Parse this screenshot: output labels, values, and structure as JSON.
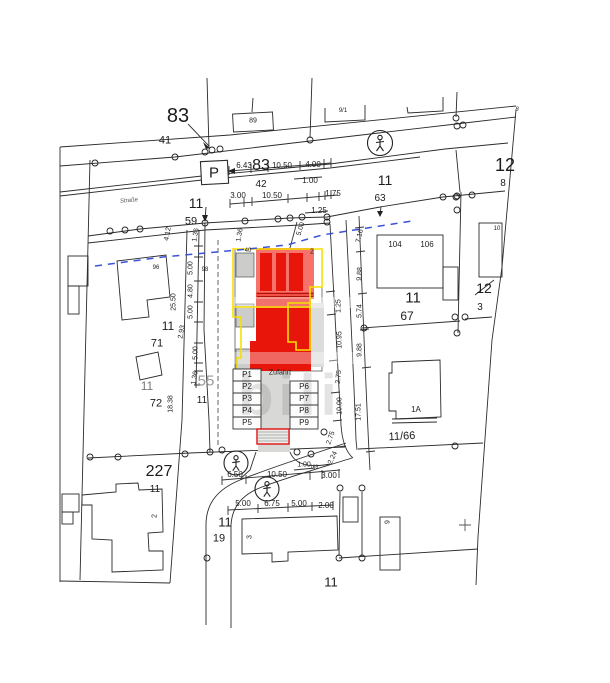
{
  "map": {
    "watermark": "bili",
    "colors": {
      "highlight_red": "#e8150b",
      "highlight_red_light": "#f5736a",
      "outline_yellow": "#f5e000",
      "guide_blue": "#3a52d8",
      "existing_gray": "#d8d8d6",
      "line_ink": "#2b2b2b"
    },
    "parking": {
      "driveway_label": "Zufahrt",
      "spaces": [
        "P1",
        "P2",
        "P3",
        "P4",
        "P5",
        "P6",
        "P7",
        "P8",
        "P9"
      ]
    },
    "labels": [
      {
        "t": "83",
        "x": 178,
        "y": 116,
        "s": 20
      },
      {
        "t": "41",
        "x": 165,
        "y": 141,
        "s": 11
      },
      {
        "t": "89",
        "x": 253,
        "y": 121,
        "s": 7
      },
      {
        "t": "9/1",
        "x": 343,
        "y": 111,
        "s": 6
      },
      {
        "t": "P",
        "x": 214,
        "y": 173,
        "s": 15
      },
      {
        "t": "6.43",
        "x": 244,
        "y": 166,
        "s": 8
      },
      {
        "t": "83",
        "x": 261,
        "y": 166,
        "s": 16
      },
      {
        "t": "10.50",
        "x": 282,
        "y": 166,
        "s": 8
      },
      {
        "t": "4.00",
        "x": 313,
        "y": 165,
        "s": 8
      },
      {
        "t": "1.00",
        "x": 310,
        "y": 181,
        "s": 8
      },
      {
        "t": "42",
        "x": 261,
        "y": 185,
        "s": 10
      },
      {
        "t": "3.00",
        "x": 238,
        "y": 196,
        "s": 8
      },
      {
        "t": "10.50",
        "x": 272,
        "y": 196,
        "s": 8
      },
      {
        "t": "1.75",
        "x": 333,
        "y": 194,
        "s": 8
      },
      {
        "t": "1.25",
        "x": 319,
        "y": 211,
        "s": 8
      },
      {
        "t": "11",
        "x": 196,
        "y": 203,
        "s": 14
      },
      {
        "t": "59",
        "x": 191,
        "y": 222,
        "s": 11
      },
      {
        "t": "11",
        "x": 385,
        "y": 180,
        "s": 14
      },
      {
        "t": "63",
        "x": 380,
        "y": 199,
        "s": 10
      },
      {
        "t": "12",
        "x": 505,
        "y": 165,
        "s": 18
      },
      {
        "t": "8",
        "x": 503,
        "y": 184,
        "s": 10
      },
      {
        "t": "8",
        "x": 517,
        "y": 110,
        "s": 6,
        "i": 1
      },
      {
        "t": "Straße",
        "x": 129,
        "y": 201,
        "s": 6,
        "r": -5,
        "c": "#555555",
        "i": 1
      },
      {
        "t": "96",
        "x": 156,
        "y": 268,
        "s": 6
      },
      {
        "t": "98",
        "x": 205,
        "y": 270,
        "s": 6
      },
      {
        "t": "25.50",
        "x": 174,
        "y": 302,
        "s": 7,
        "r": -90
      },
      {
        "t": "4.12",
        "x": 168,
        "y": 234,
        "s": 7,
        "r": -80
      },
      {
        "t": "1.36",
        "x": 196,
        "y": 235,
        "s": 7,
        "r": -80
      },
      {
        "t": "1.36",
        "x": 240,
        "y": 235,
        "s": 7,
        "r": -80
      },
      {
        "t": "5.00",
        "x": 191,
        "y": 268,
        "s": 7,
        "r": -90
      },
      {
        "t": "4.80",
        "x": 191,
        "y": 291,
        "s": 7,
        "r": -90
      },
      {
        "t": "5.00",
        "x": 191,
        "y": 312,
        "s": 7,
        "r": -90
      },
      {
        "t": "2.93",
        "x": 182,
        "y": 332,
        "s": 7,
        "r": -80
      },
      {
        "t": "5.00",
        "x": 196,
        "y": 353,
        "s": 7,
        "r": -90
      },
      {
        "t": "1.36",
        "x": 195,
        "y": 378,
        "s": 7,
        "r": -80
      },
      {
        "t": "5.00",
        "x": 301,
        "y": 229,
        "s": 7,
        "r": -72
      },
      {
        "t": "11",
        "x": 168,
        "y": 326,
        "s": 12
      },
      {
        "t": "71",
        "x": 157,
        "y": 344,
        "s": 11
      },
      {
        "t": "55",
        "x": 206,
        "y": 381,
        "s": 15,
        "c": "#999999"
      },
      {
        "t": "11",
        "x": 202,
        "y": 401,
        "s": 10
      },
      {
        "t": "11",
        "x": 147,
        "y": 386,
        "s": 12,
        "c": "#777777"
      },
      {
        "t": "72",
        "x": 156,
        "y": 404,
        "s": 11
      },
      {
        "t": "18.38",
        "x": 171,
        "y": 404,
        "s": 7,
        "r": -90
      },
      {
        "t": "104",
        "x": 395,
        "y": 245,
        "s": 8
      },
      {
        "t": "106",
        "x": 427,
        "y": 245,
        "s": 8
      },
      {
        "t": "10",
        "x": 497,
        "y": 229,
        "s": 6
      },
      {
        "t": "11",
        "x": 413,
        "y": 298,
        "s": 15
      },
      {
        "t": "67",
        "x": 407,
        "y": 316,
        "s": 12
      },
      {
        "t": "12",
        "x": 484,
        "y": 288,
        "s": 14
      },
      {
        "t": "3",
        "x": 480,
        "y": 308,
        "s": 10
      },
      {
        "t": "1.25",
        "x": 339,
        "y": 306,
        "s": 7,
        "r": -90
      },
      {
        "t": "10.95",
        "x": 340,
        "y": 340,
        "s": 7,
        "r": -90
      },
      {
        "t": "2.75",
        "x": 339,
        "y": 377,
        "s": 7,
        "r": -85
      },
      {
        "t": "10.00",
        "x": 340,
        "y": 406,
        "s": 7,
        "r": -90
      },
      {
        "t": "2.75",
        "x": 331,
        "y": 438,
        "s": 7,
        "r": -70
      },
      {
        "t": "2.24",
        "x": 333,
        "y": 458,
        "s": 7,
        "r": -65
      },
      {
        "t": "7.16",
        "x": 360,
        "y": 236,
        "s": 7,
        "r": -78
      },
      {
        "t": "9.88",
        "x": 360,
        "y": 274,
        "s": 7,
        "r": -87
      },
      {
        "t": "5.74",
        "x": 360,
        "y": 311,
        "s": 7,
        "r": -90
      },
      {
        "t": "9.88",
        "x": 360,
        "y": 350,
        "s": 7,
        "r": -90
      },
      {
        "t": "17.51",
        "x": 359,
        "y": 412,
        "s": 7,
        "r": -90
      },
      {
        "t": "1A",
        "x": 416,
        "y": 410,
        "s": 8
      },
      {
        "t": "11/66",
        "x": 402,
        "y": 437,
        "s": 11,
        "r": -3
      },
      {
        "t": "227",
        "x": 159,
        "y": 472,
        "s": 16
      },
      {
        "t": "11",
        "x": 155,
        "y": 490,
        "s": 10
      },
      {
        "t": "2",
        "x": 155,
        "y": 516,
        "s": 7,
        "r": -90
      },
      {
        "t": "11",
        "x": 225,
        "y": 522,
        "s": 13
      },
      {
        "t": "19",
        "x": 219,
        "y": 539,
        "s": 11
      },
      {
        "t": "3",
        "x": 250,
        "y": 537,
        "s": 7,
        "r": -90
      },
      {
        "t": "9",
        "x": 388,
        "y": 522,
        "s": 7,
        "r": -90
      },
      {
        "t": "11",
        "x": 331,
        "y": 582,
        "s": 13
      },
      {
        "t": "6.50",
        "x": 235,
        "y": 475,
        "s": 8
      },
      {
        "t": "10.50",
        "x": 277,
        "y": 475,
        "s": 8
      },
      {
        "t": "3.00",
        "x": 329,
        "y": 476,
        "s": 8
      },
      {
        "t": "1.00",
        "x": 304,
        "y": 465,
        "s": 7
      },
      {
        "t": "169",
        "x": 314,
        "y": 468,
        "s": 5
      },
      {
        "t": "5.00",
        "x": 243,
        "y": 504,
        "s": 8
      },
      {
        "t": "6.75",
        "x": 272,
        "y": 504,
        "s": 8
      },
      {
        "t": "5.00",
        "x": 299,
        "y": 504,
        "s": 8
      },
      {
        "t": "2.00",
        "x": 326,
        "y": 506,
        "s": 8
      },
      {
        "t": "Zufahrt",
        "x": 280,
        "y": 373,
        "s": 7
      },
      {
        "t": "P1",
        "x": 247,
        "y": 375,
        "s": 8
      },
      {
        "t": "P2",
        "x": 247,
        "y": 387,
        "s": 8
      },
      {
        "t": "P3",
        "x": 247,
        "y": 399,
        "s": 8
      },
      {
        "t": "P4",
        "x": 247,
        "y": 411,
        "s": 8
      },
      {
        "t": "P5",
        "x": 247,
        "y": 423,
        "s": 8
      },
      {
        "t": "P6",
        "x": 304,
        "y": 387,
        "s": 8
      },
      {
        "t": "P7",
        "x": 304,
        "y": 399,
        "s": 8
      },
      {
        "t": "P8",
        "x": 304,
        "y": 411,
        "s": 8
      },
      {
        "t": "P9",
        "x": 304,
        "y": 423,
        "s": 8
      },
      {
        "t": "2",
        "x": 312,
        "y": 252,
        "s": 7
      },
      {
        "t": "40",
        "x": 248,
        "y": 251,
        "s": 6
      }
    ]
  }
}
